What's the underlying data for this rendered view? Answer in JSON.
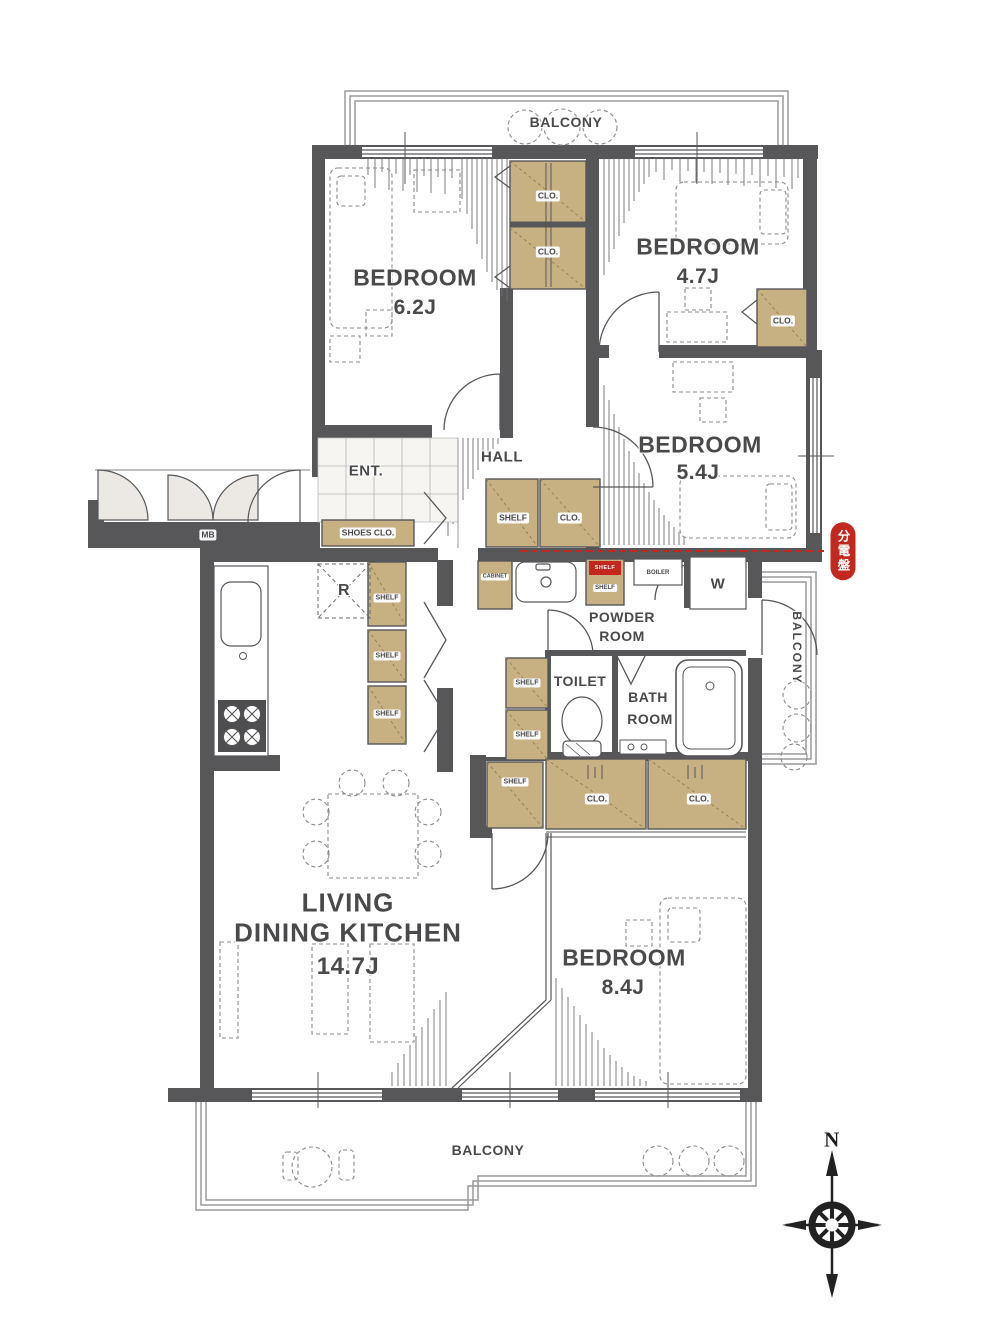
{
  "plan": {
    "balconies": {
      "top": "BALCONY",
      "right": "BALCONY",
      "bottom": "BALCONY"
    },
    "compass": {
      "north": "N"
    },
    "rooms": {
      "bedroom_a": {
        "name": "BEDROOM",
        "size": "6.2J"
      },
      "bedroom_b": {
        "name": "BEDROOM",
        "size": "4.7J"
      },
      "bedroom_c": {
        "name": "BEDROOM",
        "size": "5.4J"
      },
      "bedroom_d": {
        "name": "BEDROOM",
        "size": "8.4J"
      },
      "ldk": {
        "line1": "LIVING",
        "line2": "DINING KITCHEN",
        "size": "14.7J"
      },
      "hall": {
        "name": "HALL"
      },
      "entrance": {
        "name": "ENT."
      },
      "powder": {
        "line1": "POWDER",
        "line2": "ROOM"
      },
      "toilet": {
        "name": "TOILET"
      },
      "bath": {
        "line1": "BATH",
        "line2": "ROOM"
      }
    },
    "storage": {
      "closet": "CLO.",
      "shelf": "SHELF",
      "shoes_closet": "SHOES CLO.",
      "cabinet": "CABINET"
    },
    "fixtures": {
      "washing_machine": "W",
      "boiler": "BOILER",
      "refrigerator": "R",
      "meter_box": "MB",
      "distribution_board": "分電盤"
    },
    "colors": {
      "wall": "#57575a",
      "closet_fill": "#c7b183",
      "accent_red": "#c2281e",
      "text": "#4a4a4c"
    }
  }
}
